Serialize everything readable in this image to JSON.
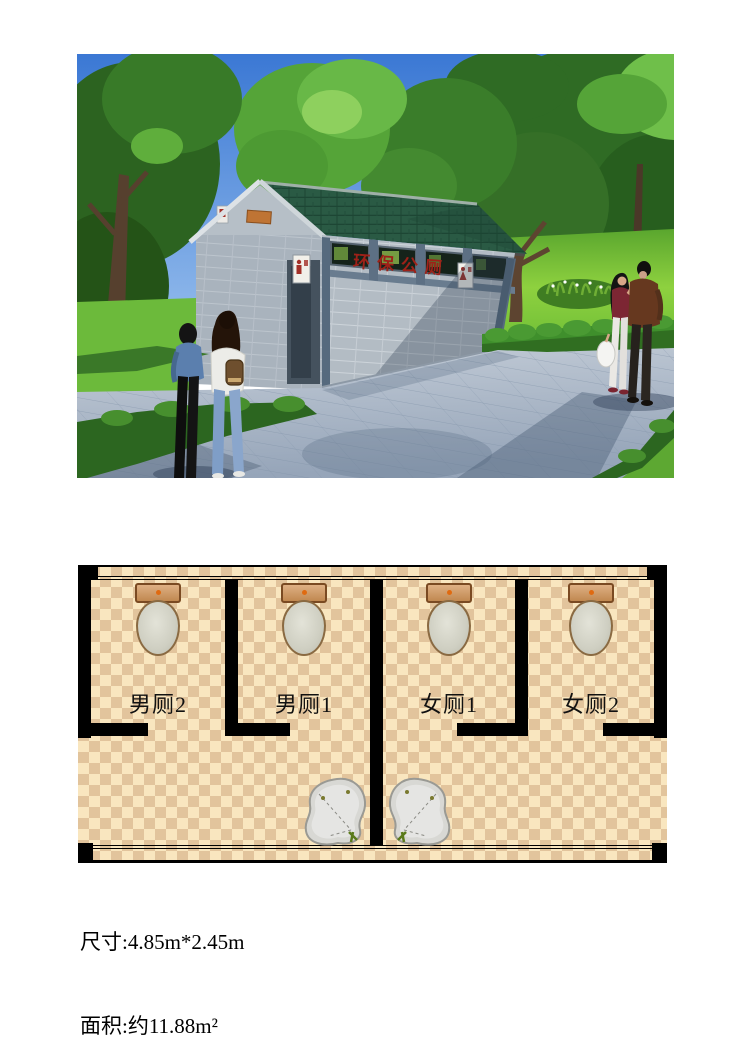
{
  "photo": {
    "building_sign": "环保公厕",
    "icons": [
      "male-restroom-sign",
      "female-restroom-sign"
    ],
    "colors": {
      "sky": "#3b78d4",
      "tree_green": "#2f6b24",
      "grass": "#7cc140",
      "roof": "#2a5a44",
      "wall": "#b3bcc4",
      "plaza": "#b9c3cf",
      "hedge": "#2c6620",
      "sign_text": "#9e2118"
    }
  },
  "floor_plan": {
    "stalls": [
      {
        "label": "男厕2"
      },
      {
        "label": "男厕1"
      },
      {
        "label": "女厕1"
      },
      {
        "label": "女厕2"
      }
    ],
    "colors": {
      "floor_light": "#f9e6bf",
      "floor_dark": "#e2c49c",
      "wall": "#000000",
      "toilet_tank": "#c98f5f",
      "toilet_bowl": "#d2d2c6",
      "basin": "#d8d8d4"
    }
  },
  "specs": {
    "line1": "尺寸:4.85m*2.45m",
    "line2": "面积:约11.88m²"
  }
}
